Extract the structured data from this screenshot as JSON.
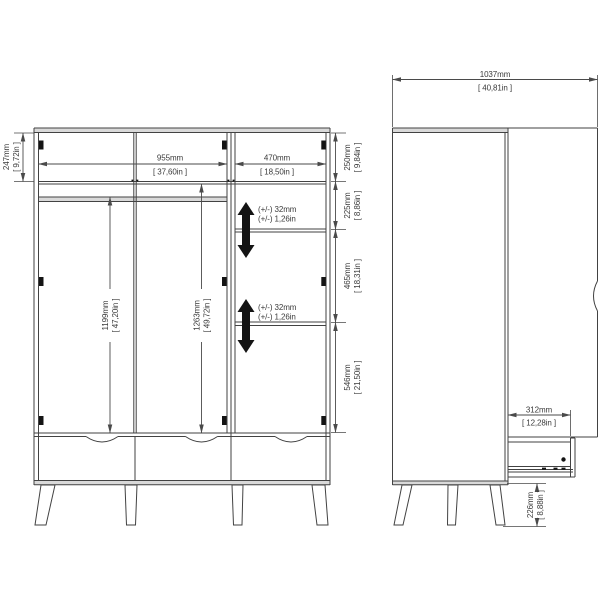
{
  "front_view": {
    "top_section_height": {
      "mm": "247mm",
      "inch": "[ 9,72in ]"
    },
    "left_compartment_width": {
      "mm": "955mm",
      "inch": "[ 37,60in ]"
    },
    "right_compartment_width": {
      "mm": "470mm",
      "inch": "[ 18,50in ]"
    },
    "right_side_sections": [
      {
        "mm": "250mm",
        "inch": "[ 9,84in ]"
      },
      {
        "mm": "225mm",
        "inch": "[ 8,86in ]"
      },
      {
        "mm": "465mm",
        "inch": "[ 18,31in ]"
      },
      {
        "mm": "546mm",
        "inch": "[ 21,50in ]"
      }
    ],
    "left_hanging_height": {
      "mm": "1199mm",
      "inch": "[ 47,20in ]"
    },
    "middle_hanging_height": {
      "mm": "1263mm",
      "inch": "[ 49,72in ]"
    },
    "shelf_adjustment": {
      "mm": "(+/-) 32mm",
      "inch": "(+/-) 1,26in"
    }
  },
  "side_view": {
    "total_depth": {
      "mm": "1037mm",
      "inch": "[ 40,81in ]"
    },
    "drawer_extension": {
      "mm": "312mm",
      "inch": "[ 12,28in ]"
    },
    "leg_height": {
      "mm": "226mm",
      "inch": "[ 8,88in ]"
    }
  }
}
